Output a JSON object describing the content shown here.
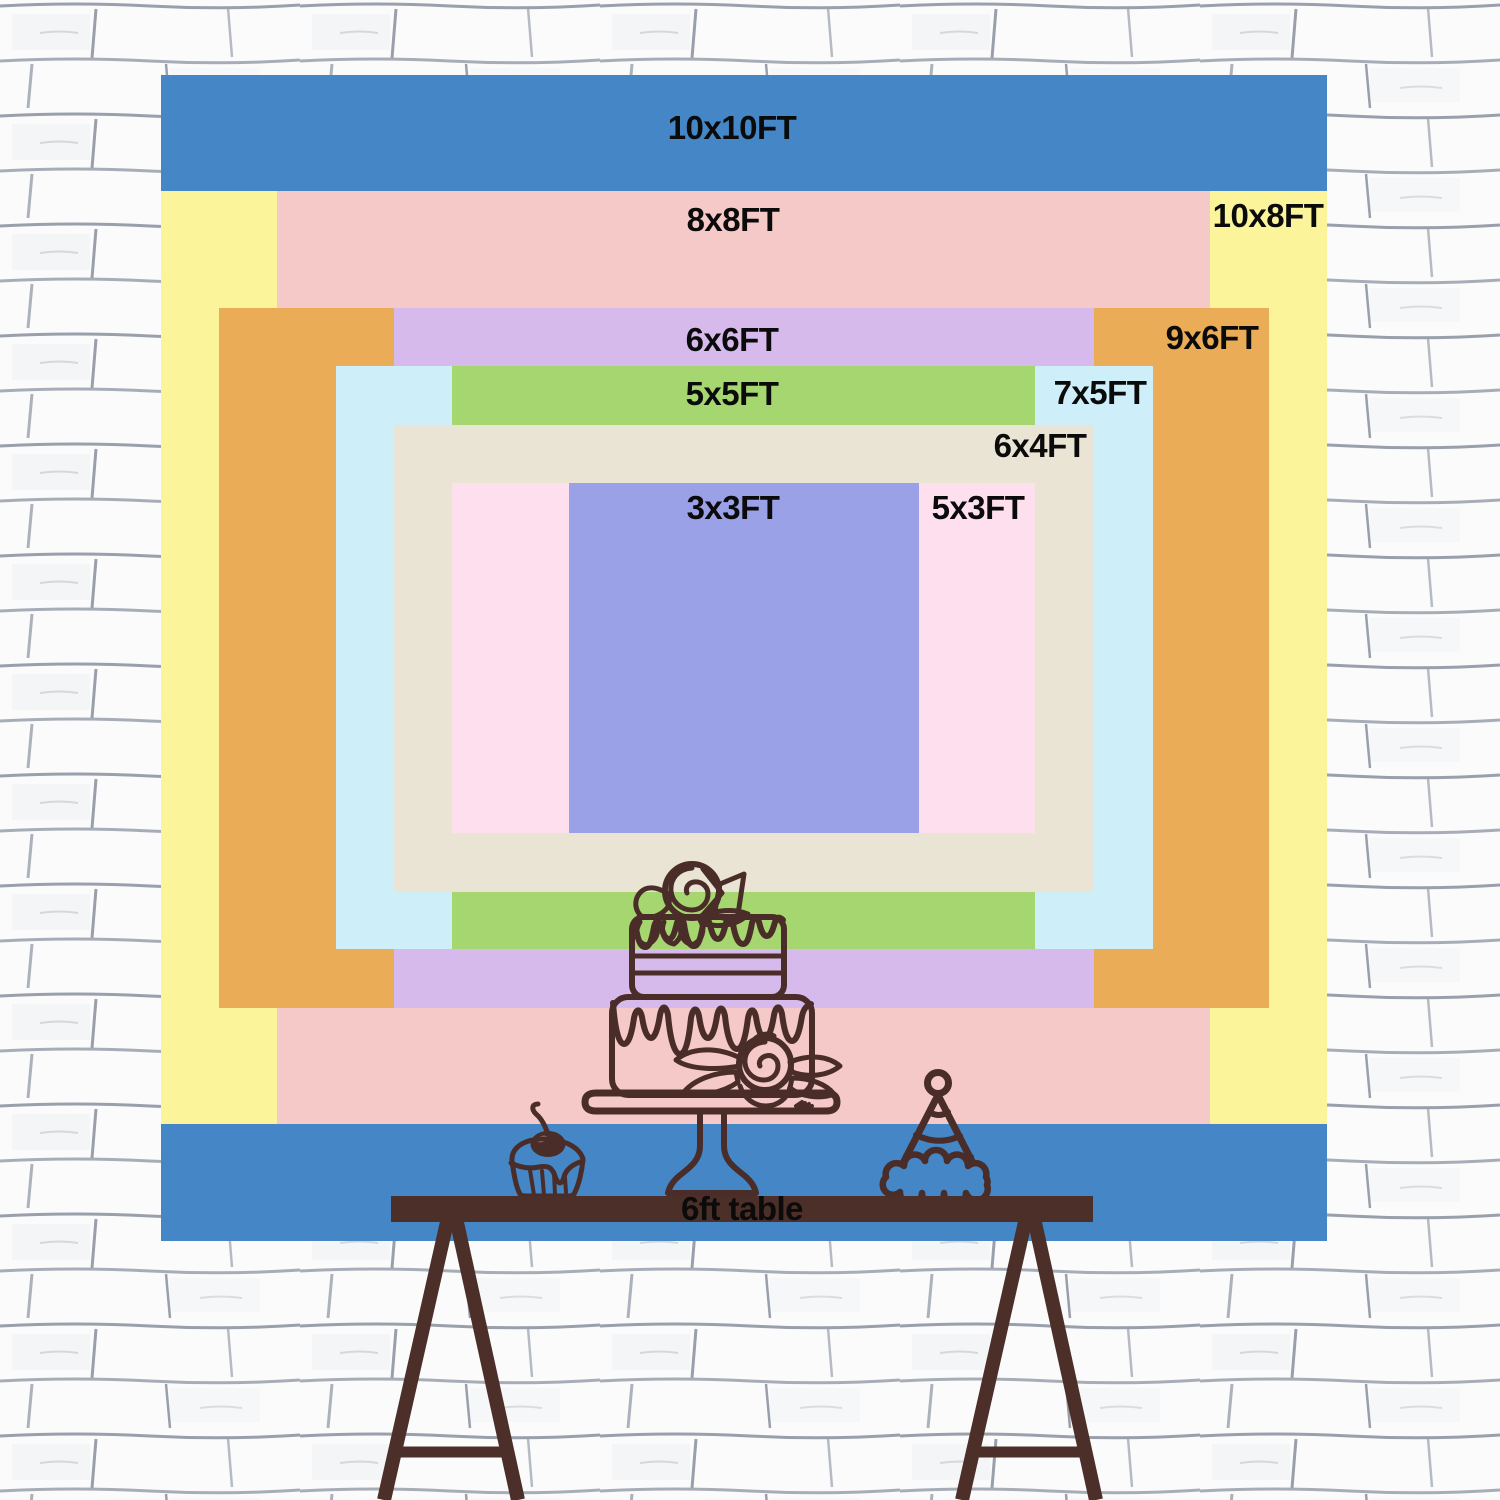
{
  "backdrop": {
    "description": "backdrop size comparison chart",
    "sizes": [
      {
        "id": "10x10",
        "label": "10x10FT",
        "color": "#4486C6"
      },
      {
        "id": "10x8",
        "label": "10x8FT",
        "color": "#FBF49B"
      },
      {
        "id": "8x8",
        "label": "8x8FT",
        "color": "#F5C9C8"
      },
      {
        "id": "9x6",
        "label": "9x6FT",
        "color": "#EBAC58"
      },
      {
        "id": "6x6",
        "label": "6x6FT",
        "color": "#D6BAEC"
      },
      {
        "id": "7x5",
        "label": "7x5FT",
        "color": "#CEEFFA"
      },
      {
        "id": "5x5",
        "label": "5x5FT",
        "color": "#A6D66F"
      },
      {
        "id": "6x4",
        "label": "6x4FT",
        "color": "#EAE4D4"
      },
      {
        "id": "5x3",
        "label": "5x3FT",
        "color": "#FDDFEE"
      },
      {
        "id": "3x3",
        "label": "3x3FT",
        "color": "#9AA1E7"
      }
    ]
  },
  "table": {
    "label": "6ft table",
    "color": "#4C2F28"
  },
  "lineart": {
    "color": "#4A2D28",
    "items": [
      "birthday-cake-on-stand",
      "cupcake-with-cherry",
      "party-hat"
    ]
  },
  "wall": {
    "background": "#FBFBFC",
    "mortar": "#99A0AB"
  },
  "text_color": "#0B0B0B"
}
